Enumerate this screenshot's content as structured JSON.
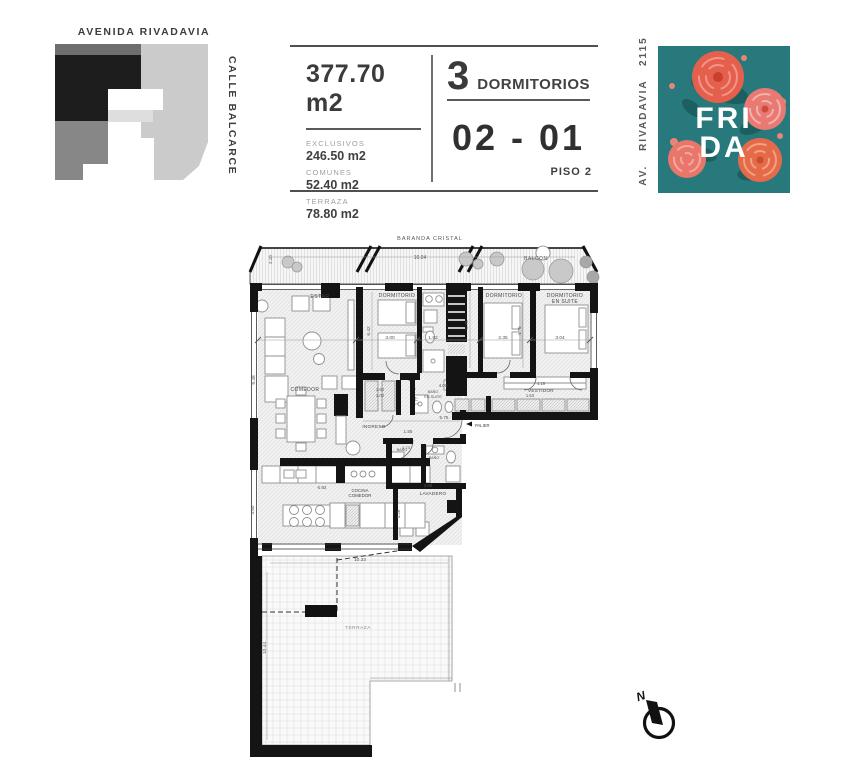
{
  "header": {
    "map": {
      "street_top": "AVENIDA RIVADAVIA",
      "street_right": "CALLE BALCARCE"
    },
    "specs": {
      "total_area": "377.70 m2",
      "exclusivos_label": "EXCLUSIVOS",
      "exclusivos_value": "246.50 m2",
      "comunes_label": "COMUNES",
      "comunes_value": "52.40 m2",
      "terraza_label": "TERRAZA",
      "terraza_value": "78.80 m2",
      "bedrooms_number": "3",
      "bedrooms_label": "DORMITORIOS",
      "unit": "02 - 01",
      "floor_label": "PISO 2"
    },
    "brand": {
      "address": "AV.  RIVADAVIA   2115",
      "logo_line1": "FRI",
      "logo_line2": "DA",
      "teal": "#27797b",
      "rose_coral": "#e8705f"
    }
  },
  "plan": {
    "balcony": {
      "baranda_label": "BARANDA CRISTAL",
      "balcon_label": "BALCON",
      "width_dim": "16.04",
      "left_dim": "2.10"
    },
    "rooms": {
      "estar": "ESTAR",
      "dormitorio_1": "DORMITORIO",
      "dormitorio_2": "DORMITORIO",
      "suite_line1": "DORMITORIO",
      "suite_line2": "EN SUITE",
      "comedor": "COMEDOR",
      "ingreso": "INGRESO",
      "vestidor": "VESTIDOR",
      "palier": "PALIER",
      "bano_1": "BAÑO",
      "bano_2": "BAÑO",
      "bano_suite_line1": "BAÑO",
      "bano_suite_line2": "EN SUITE",
      "lavadero": "LAVADERO",
      "cocina_line1": "COCINA",
      "cocina_line2": "COMEDOR",
      "terraza": "TERRAZA"
    },
    "dims": {
      "estar_h": "9.48",
      "dorm1_h": "6.42",
      "dorm1_w": "3.00",
      "pasillo_w": "1.82",
      "dorm2_h": "5.75",
      "dorm2_w": "2.35",
      "suite_h": "4.75",
      "suite_w": "3.04",
      "ingreso_w": "5.75",
      "ingreso_h": "1.55",
      "bano_suite_w": "4.00",
      "bano_suite_h": "1.77",
      "closet_w": "1.60",
      "closet_w2": "1.00",
      "vestidor_w": "4.19",
      "vestidor_h": "1.63",
      "bano_w": "1.73",
      "cocina_w": "6.92",
      "cocina_h": "3.60",
      "lavadero_w": "3.69",
      "lavadero_h": "3.26",
      "terraza_w": "10.33",
      "terraza_h": "10.44"
    },
    "compass": {
      "north": "N"
    }
  }
}
